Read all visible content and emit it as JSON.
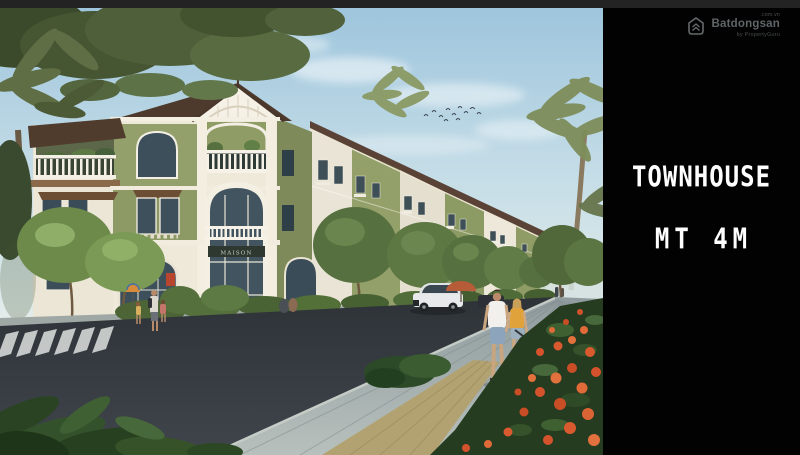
{
  "panel": {
    "title": "TOWNHOUSE",
    "subtitle": "MT 4M",
    "background": "#020202",
    "text_color": "#ffffff"
  },
  "watermark": {
    "brand": "Batdongsan",
    "suffix": ".com.vn",
    "byline": "by PropertyGuru"
  },
  "scene": {
    "shop_sign": "MAISON",
    "alt": "Architectural rendering of a street of 3-storey green and cream townhouses with palm trees, a white SUV, pedestrians with a stroller on a paved promenade, and orange flowers in the foreground",
    "palette": {
      "sky_top": "#9cc4dc",
      "sky_horizon": "#e3edea",
      "building_green": "#93a06b",
      "building_cream": "#efe9da",
      "roof_brown": "#4e3a2c",
      "road": "#31363b",
      "sidewalk": "#9aa6a8",
      "flower_orange": "#d4532c",
      "foliage_dark": "#3c512f",
      "umbrella_red": "#b75c38"
    }
  }
}
